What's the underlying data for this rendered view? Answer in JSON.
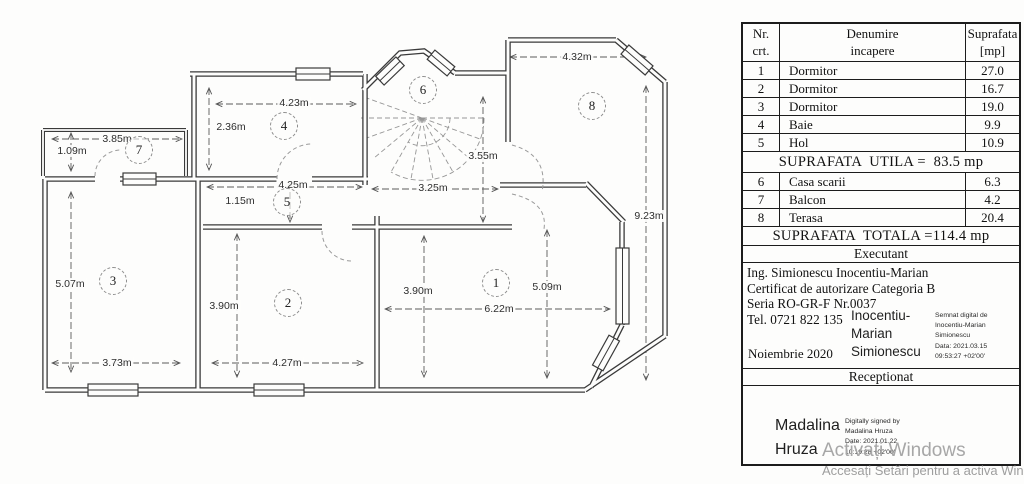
{
  "table": {
    "columns": [
      "Nr.\ncrt.",
      "Denumire\nincapere",
      "Suprafata\n[mp]"
    ],
    "rows_main": [
      [
        "1",
        "Dormitor",
        "27.0"
      ],
      [
        "2",
        "Dormitor",
        "16.7"
      ],
      [
        "3",
        "Dormitor",
        "19.0"
      ],
      [
        "4",
        "Baie",
        "9.9"
      ],
      [
        "5",
        "Hol",
        "10.9"
      ]
    ],
    "utila_text": "SUPRAFATA  UTILA =  83.5 mp",
    "rows_extra": [
      [
        "6",
        "Casa scarii",
        "6.3"
      ],
      [
        "7",
        "Balcon",
        "4.2"
      ],
      [
        "8",
        "Terasa",
        "20.4"
      ]
    ],
    "totala_text": "SUPRAFATA  TOTALA =114.4 mp",
    "executant_label": "Executant",
    "executant": {
      "line1": "Ing. Simionescu Inocentiu-Marian",
      "line2": "Certificat de autorizare Categoria B",
      "line3": "Seria RO-GR-F Nr.0037",
      "line4": "Tel. 0721 822 135",
      "date": "Noiembrie 2020",
      "signature_name": "Inocentiu-\nMarian\nSimionescu",
      "signature_note": "Semnat digital de\nInocentiu-Marian\nSimionescu\nData: 2021.03.15\n09:53:27 +02'00'"
    },
    "receptionat_label": "Receptionat",
    "receptionat": {
      "signature_name": "Madalina\nHruza",
      "signature_note": "Digitally signed by\nMadalina Hruza\nDate: 2021.01.22\n10:19:28 +02'00'"
    }
  },
  "watermark": {
    "line1": "Activați Windows",
    "line2": "Accesați Setări pentru a activa Windows"
  },
  "plan": {
    "rooms": [
      {
        "id": "1",
        "x": 496,
        "y": 283
      },
      {
        "id": "2",
        "x": 288,
        "y": 303
      },
      {
        "id": "3",
        "x": 113,
        "y": 281
      },
      {
        "id": "4",
        "x": 284,
        "y": 126
      },
      {
        "id": "5",
        "x": 287,
        "y": 202
      },
      {
        "id": "6",
        "x": 423,
        "y": 90
      },
      {
        "id": "7",
        "x": 139,
        "y": 150
      },
      {
        "id": "8",
        "x": 592,
        "y": 106
      }
    ],
    "dimensions": [
      {
        "label": "3.85m",
        "x": 117,
        "y": 139
      },
      {
        "label": "1.09m",
        "x": 72,
        "y": 151
      },
      {
        "label": "5.07m",
        "x": 70,
        "y": 284
      },
      {
        "label": "3.73m",
        "x": 117,
        "y": 363
      },
      {
        "label": "3.90m",
        "x": 224,
        "y": 306
      },
      {
        "label": "4.27m",
        "x": 287,
        "y": 363
      },
      {
        "label": "4.23m",
        "x": 294,
        "y": 103
      },
      {
        "label": "2.36m",
        "x": 231,
        "y": 127
      },
      {
        "label": "4.25m",
        "x": 293,
        "y": 185
      },
      {
        "label": "1.15m",
        "x": 240,
        "y": 201
      },
      {
        "label": "3.25m",
        "x": 433,
        "y": 188
      },
      {
        "label": "3.55m",
        "x": 483,
        "y": 156
      },
      {
        "label": "3.90m",
        "x": 418,
        "y": 291
      },
      {
        "label": "6.22m",
        "x": 499,
        "y": 309
      },
      {
        "label": "5.09m",
        "x": 547,
        "y": 287
      },
      {
        "label": "4.32m",
        "x": 577,
        "y": 57
      },
      {
        "label": "9.23m",
        "x": 649,
        "y": 216
      }
    ]
  }
}
